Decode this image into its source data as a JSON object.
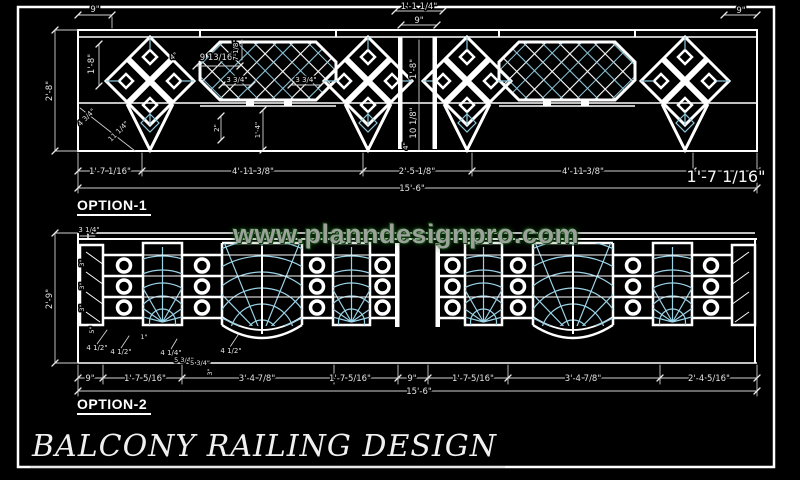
{
  "watermark": {
    "text": "www.planndesignpro.com"
  },
  "title": {
    "text": "BALCONY RAILING DESIGN"
  },
  "colors": {
    "background": "#000000",
    "line": "#ffffff",
    "lattice": "#8ec6da",
    "fan": "#9ad2e6",
    "dim_text": "#e2e2e2",
    "watermark": "#9aa29a",
    "watermark_glow": "#0e3f0e"
  },
  "option1": {
    "label": "OPTION-1",
    "dims": {
      "top_left": "9\"",
      "top_center_upper": "1'-1 1/4\"",
      "top_center_lower": "9\"",
      "top_right": "9\"",
      "overall_height": "2'-8\"",
      "panel_height": "1'-8\"",
      "diag_small": "4 3/4\"",
      "diag_large": "11 1/4\"",
      "detail_4": "4\"",
      "lattice_width": "9 13/16\"",
      "lattice_height": "7 1/8\"",
      "cell_left": "3 3/4\"",
      "cell_right": "3 3/4\"",
      "drop_small": "2\"",
      "drop_large": "1'-4\"",
      "gap_panel_height": "1'-8\"",
      "gap_drop": "10 1/8\"",
      "gap_small": "4\"",
      "bottom": [
        "1'-7 1/16\"",
        "4'-11 3/8\"",
        "2'-5 1/8\"",
        "4'-11 3/8\""
      ],
      "bottom_right_large": "1'-7 1/16\"",
      "overall_width": "15'-6\""
    }
  },
  "option2": {
    "label": "OPTION-2",
    "dims": {
      "overall_height": "2'-9\"",
      "top_step": "3 1/4\"",
      "post": [
        "3\"",
        "3\"",
        "3\"",
        "5\""
      ],
      "detail": [
        "4 1/2\"",
        "4 1/2\"",
        "1\"",
        "4 1/4\"",
        "5 3/4\"",
        "5 3/4\"",
        "4 1/2\"",
        "3\""
      ],
      "bottom": [
        "9\"",
        "1'-7 5/16\"",
        "3'-4 7/8\"",
        "1'-7 5/16\"",
        "9\"",
        "1'-7 5/16\"",
        "3'-4 7/8\"",
        "2'-4 5/16\""
      ],
      "overall_width": "15'-6\""
    }
  }
}
